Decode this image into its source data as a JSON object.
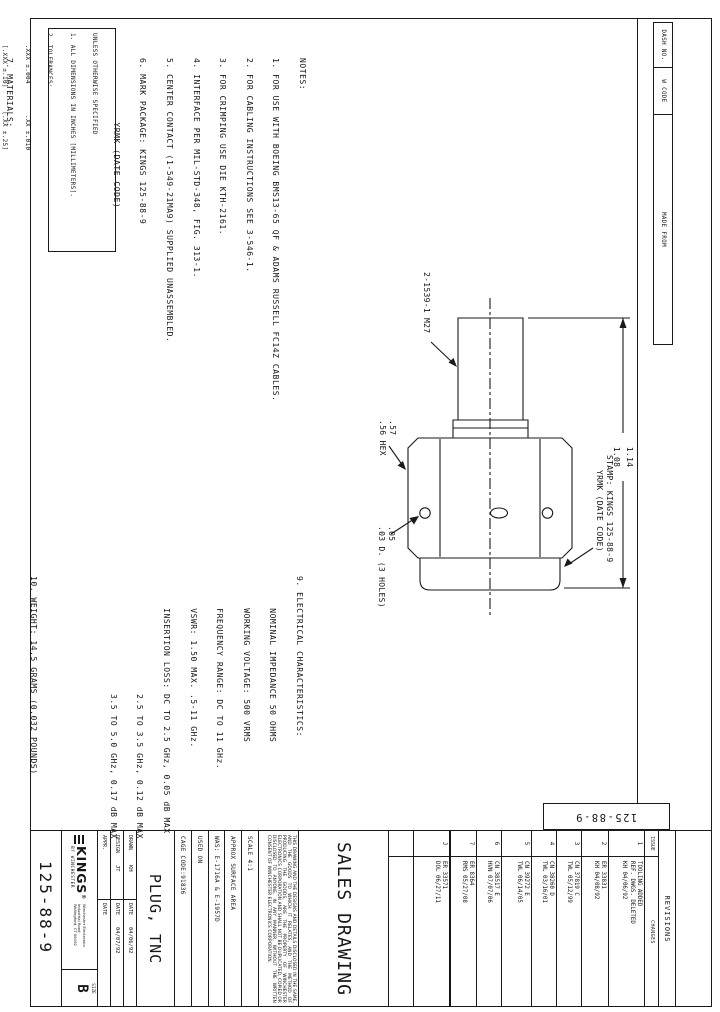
{
  "sheet": {
    "corner_number": "125-88-9",
    "tab_headers": [
      "DASH NO.",
      "W CODE",
      "MADE FROM"
    ]
  },
  "notes_lines": [
    "NOTES:",
    "1. FOR USE WITH BOEING BMS13-65 QF & ADAMS RUSSELL FC14Z CABLES.",
    "2. FOR CABLING INSTRUCTIONS SEE 3-546-1.",
    "3. FOR CRIMPING USE DIE KTH-2161.",
    "4. INTERFACE PER MIL-STD-348, FIG. 313-1.",
    "5. CENTER CONTACT (1-549-21MA9) SUPPLIED UNASSEMBLED.",
    "6. MARK PACKAGE: KINGS 125-88-9",
    "            YRMK (DATE CODE)",
    "",
    "",
    "",
    "7. MATERIALS:",
    "      INSULATOR: TEFLON, ASTM-D-1710",
    "      K-GRIP SLEEVE: COM. BRONZE TUBE, ASTM B135",
    "      OUTER CONTACT: BER. COPPER, ASTM-B-196",
    "      GASKET: SILICONE RUBBER, A-A-59588",
    "      C-RING: PHOSPHOR BRONZE, ASTM B103",
    "      ALL OTHER METAL PARTS: BRASS, ASTM-B16",
    "8. FINISHES:",
    "      CENTER CONTACT: .000050 MIN GOLD PER ASTM B488 OVER .000050 MIN NICKEL PER AMS-QQ-N-290(RoHS)",
    "      ALL OTHER METAL PARTS: .000050 MIN NICKEL PLATE PER AMS-QQ-N-290 OVER .000050 MIN COPPER PER ASTM B734(RoHS)"
  ],
  "elec_lines": [
    "9. ELECTRICAL CHARACTERISTICS:",
    "      NOMINAL IMPEDANCE 50 OHMS",
    "      WORKING VOLTAGE: 500 VRMS",
    "      FREQUENCY RANGE: DC TO 11 GHz.",
    "      VSWR: 1.50 MAX. .5-11 GHz.",
    "      INSERTION LOSS: DC TO 2.5 GHz, 0.05 dB MAX",
    "                      2.5 TO 3.5 GHz, 0.12 dB MAX",
    "                      3.5 TO 5.0 GHz, 0.17 dB MAX",
    "",
    "",
    "10. WEIGHT: 14.5 GRAMS (0.032 POUNDS)"
  ],
  "tolerance_lines": [
    "UNLESS OTHERWISE SPECIFIED",
    "1. ALL DIMENSIONS IN INCHES [MILLIMETERS].",
    "2. TOLERANCES:",
    "   .XXX ±.004        .XX ±.010",
    "   [.XXX ±.10]      [.XX ±.25]",
    "   FRACTIONS: X/Y ±.010 [.25]   ANGLES: ± 1°",
    "✱ CRITICAL DIMENSIONS"
  ],
  "figure": {
    "sleeve_label": "2-1539-1 M27",
    "hex_size_1": ".57",
    "hex_size_2": ".56 HEX",
    "holes_1": ".05",
    "holes_2": ".03 D. (3 HOLES)",
    "stamp_1": "STAMP: KINGS 125-88-9",
    "stamp_2": "YRMK (DATE CODE)",
    "dim_1": "1.14",
    "dim_2": "1.08"
  },
  "revisions": {
    "title": "REVISIONS",
    "issue_label": "ISSUE",
    "changes_label": "CHANGES",
    "rows": [
      {
        "issue": "1",
        "lines": [
          "TOOLING ADDED",
          "REF. DWGS. DELETED",
          "KH 04/06/92"
        ]
      },
      {
        "issue": "2",
        "lines": [
          "ER 33831",
          "KH 04/08/92"
        ]
      },
      {
        "issue": "3",
        "lines": [
          "CN 37819 C",
          "TWL 05/12/99"
        ]
      },
      {
        "issue": "4",
        "lines": [
          "CN 38260 D",
          "TWL 03/16/01"
        ]
      },
      {
        "issue": "5",
        "lines": [
          "CN 39272 E",
          "TWL 06/14/05"
        ]
      },
      {
        "issue": "6",
        "lines": [
          "CN 38517 E",
          "HVN 07/07/06"
        ]
      },
      {
        "issue": "7",
        "lines": [
          "ER 8364",
          "RMS 05/27/08"
        ]
      },
      {
        "issue": "J",
        "lines": [
          "ER 33571",
          "DOL 06/27/11"
        ]
      }
    ]
  },
  "title_block": {
    "doc_type": "SALES DRAWING",
    "disclaimer": "THIS DRAWING AND THE DESIGNS AND DETAILS DISCLOSED IN THE SAME, AND THE GOODS TO WHICH IT RELATES, AND THE METHOD OF PRODUCING THE GOODS, ARE THE PROPERTY OF WINCHESTER ELECTRONICS CORPORATION AND SHALL NOT BE DUPLICATED, COPIED OR DISCLOSED TO ANYONE, IN ANY MANNER, WITHOUT THE WRITTEN CONSENT OF WINCHESTER ELECTRONICS CORPORATION.",
    "scale_text": "SCALE   4:1",
    "surface_label": "APPROX SURFACE AREA",
    "was_value": "WAS: E-1716A & E-1957D",
    "used_on_label": "USED ON",
    "cage_code": "CAGE CODE:91836",
    "part_title": "PLUG, TNC",
    "drawn_label": "DRAWN",
    "drawn_by": "KH",
    "design_label": "DESIGN",
    "design_by": "JT",
    "appr_label": "APPR.",
    "date_label": "DATE",
    "drawn_date": "04/06/92",
    "design_date": "04/07/92",
    "brand": "KINGS",
    "brand_by": "BY WINCHESTER",
    "address_1": "Winchester Electronics",
    "address_2": "Industrial Road",
    "address_3": "Wallingford, CT 06492",
    "size_label": "SIZE",
    "size_value": "B",
    "drawing_number": "125-88-9"
  }
}
